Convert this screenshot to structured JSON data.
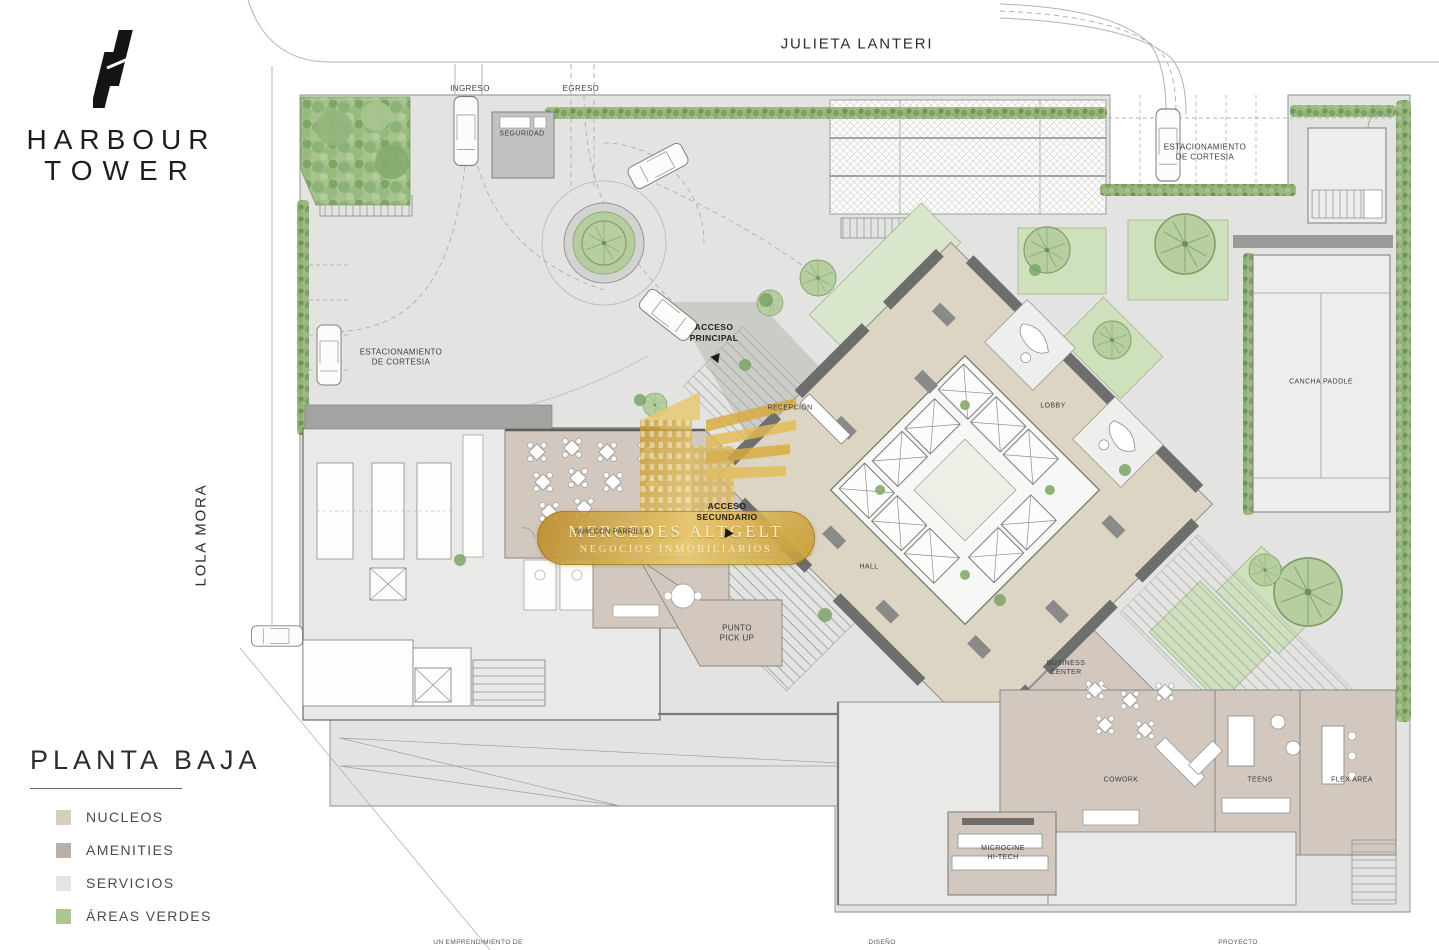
{
  "branding": {
    "line1": "HARBOUR",
    "line2": "TOWER"
  },
  "streets": {
    "top": "JULIETA LANTERI",
    "left": "LOLA MORA"
  },
  "title_block": {
    "title": "PLANTA BAJA",
    "legend": [
      {
        "label": "NUCLEOS",
        "color": "#d6cfbd"
      },
      {
        "label": "AMENITIES",
        "color": "#b9b0aa"
      },
      {
        "label": "SERVICIOS",
        "color": "#e4e4e2"
      },
      {
        "label": "ÁREAS VERDES",
        "color": "#a9c693"
      }
    ]
  },
  "plan": {
    "labels": {
      "ingreso": "INGRESO",
      "egreso": "EGRESO",
      "seguridad": "SEGURIDAD",
      "estacionamiento_left": "ESTACIONAMIENTO\nDE CORTESIA",
      "estacionamiento_right": "ESTACIONAMIENTO\nDE CORTESIA",
      "acceso_principal": "ACCESO\nPRINCIPAL",
      "acceso_secundario": "ACCESO\nSECUNDARIO",
      "recepcion": "RECEPCIÓN",
      "lobby": "LOBBY",
      "hall": "HALL",
      "cancha_paddle": "CANCHA PADDLE",
      "sum_con_parrilla": "SUM CON PARRILLA",
      "punto_pick_up": "PUNTO\nPICK UP",
      "business_center": "BUSINESS\nCENTER",
      "cowork": "COWORK",
      "teens": "TEENS",
      "flex_area": "FLEX AREA",
      "microcine": "MICROCINE\nHI-TECH"
    }
  },
  "watermark": {
    "line1": "MERCEDES ALTGELT",
    "line2": "NEGOCIOS INMOBILIARIOS"
  },
  "footer": {
    "left": "UN EMPRENDIMIENTO DE",
    "center": "DISEÑO",
    "right": "PROYECTO"
  },
  "colors": {
    "site_ground": "#e3e4e1",
    "nucleos": "#dcd5c3",
    "amenities": "#d2c8bf",
    "servicios": "#e9e9e7",
    "green_area": "#b5cc9e",
    "pale_green": "#d9e6cb",
    "hedge_green": "#8bb070",
    "wall_gray": "#6e6e6c",
    "watermark_gold": "#d4a945"
  }
}
